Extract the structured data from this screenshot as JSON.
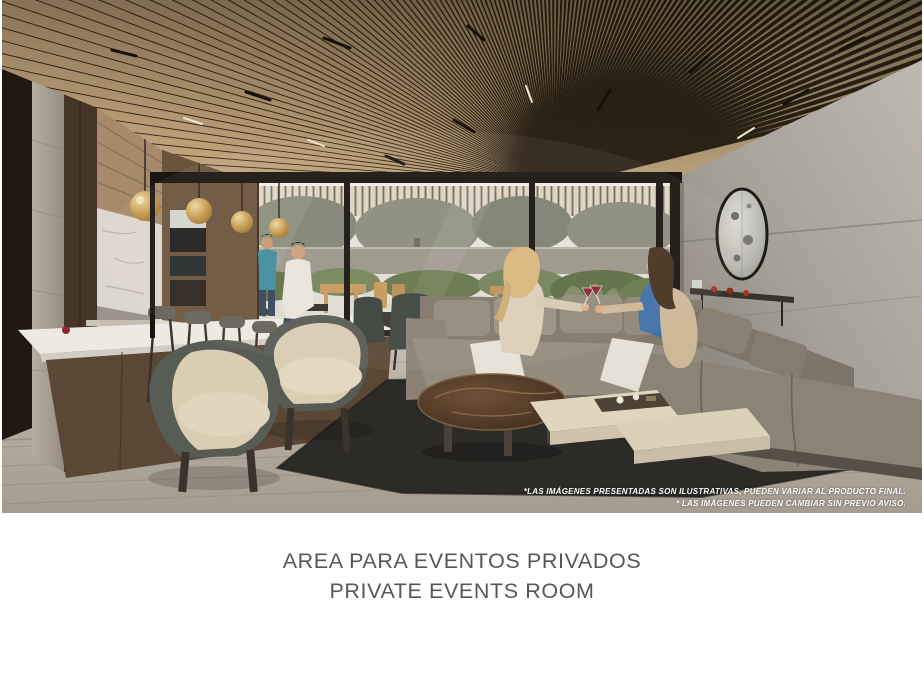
{
  "slide": {
    "caption": {
      "line1": "AREA PARA EVENTOS PRIVADOS",
      "line2": "PRIVATE EVENTS ROOM",
      "text_color": "#56575b"
    },
    "rendering": {
      "subject": "interior-rendering-private-events-room",
      "disclaimer": {
        "line1": "*LAS IMÁGENES PRESENTADAS SON ILUSTRATIVAS, PUEDEN VARIAR AL PRODUCTO FINAL.",
        "line2": "* LAS IMÁGENES PUEDEN CAMBIAR SIN PREVIO AVISO.",
        "text_color": "#ffffff"
      },
      "palette": {
        "ceiling_wood": "#bfa37d",
        "ceiling_gap": "#2f2518",
        "glass_frame": "#191510",
        "stone_wall": "#aaa59d",
        "sofa_gray": "#8c8478",
        "accent_chair_cream": "#d9cdb4",
        "accent_chair_shell": "#565b53",
        "rug_charcoal": "#2d2b28",
        "floor_wood": "#b4aca0",
        "marble_table": "#56402d",
        "pendant_gold": "#c59b4e",
        "greenery": "#6d7d52",
        "island_marble": "#eceae3"
      }
    }
  }
}
